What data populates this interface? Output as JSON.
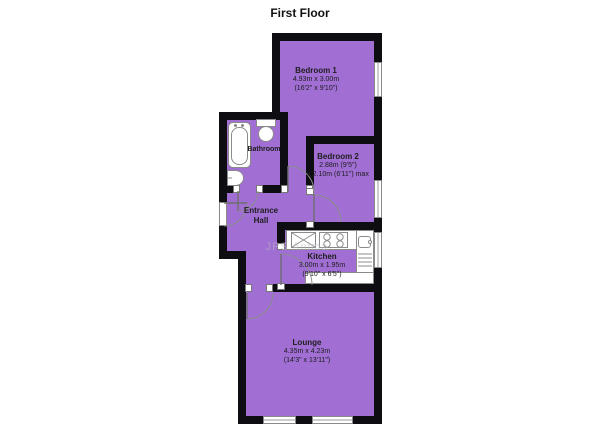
{
  "title": "First Floor",
  "watermark": "JPS Anima",
  "colors": {
    "floor_fill": "#a16fd4",
    "wall": "#0e0d12",
    "fixture_outline": "#8a8a8a",
    "text": "#1c1c1c"
  },
  "rooms": {
    "bedroom1": {
      "name": "Bedroom 1",
      "dim_metric": "4.93m x 3.00m",
      "dim_imperial": "(16'2\" x 9'10\")"
    },
    "bedroom2": {
      "name": "Bedroom 2",
      "dim_metric": "2.88m (9'5\")",
      "dim_imperial": "x 2.10m (6'11\") max"
    },
    "bathroom": {
      "name": "Bathroom"
    },
    "entrance_hall": {
      "name": "Entrance Hall",
      "line1": "Entrance",
      "line2": "Hall"
    },
    "kitchen": {
      "name": "Kitchen",
      "dim_metric": "3.00m x 1.95m",
      "dim_imperial": "(9'10\" x 6'5\")"
    },
    "lounge": {
      "name": "Lounge",
      "dim_metric": "4.35m x 4.23m",
      "dim_imperial": "(14'3\" x 13'11\")"
    }
  },
  "fixtures": {
    "bathtub": "bathtub",
    "toilet": "toilet",
    "basin": "basin",
    "kitchen_sink": "sink-with-cross",
    "hob": "hob-4-rings",
    "sink_drainer": "sink-drainer-unit"
  }
}
